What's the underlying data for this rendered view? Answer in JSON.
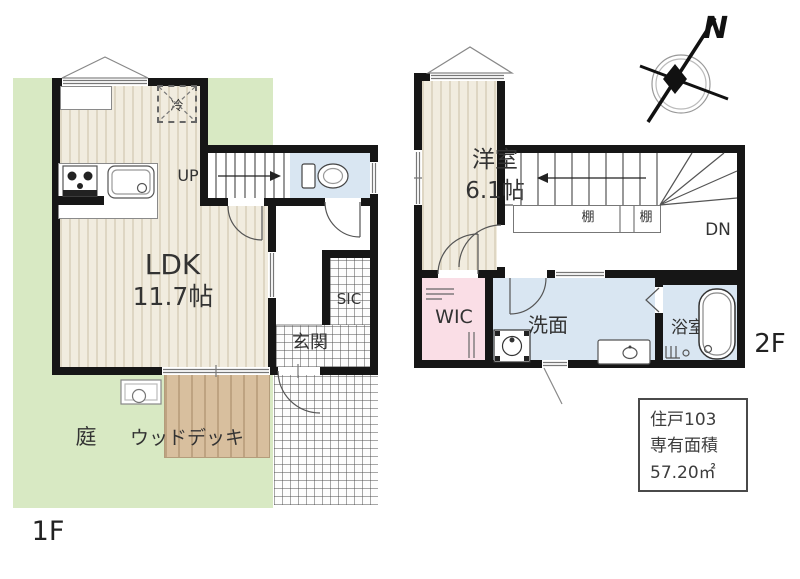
{
  "colors": {
    "garden_green": "#d8e9c3",
    "deck_tan": "#d8bf9e",
    "room_beige": "#f1ecdf",
    "water_blue": "#d9e6f2",
    "wic_pink": "#fadee6",
    "wall_black": "#161616"
  },
  "f1": {
    "floor_label": "1F",
    "ldk_name": "LDK",
    "ldk_size": "11.7帖",
    "garden": "庭",
    "wood_deck": "ウッドデッキ",
    "entrance": "玄関",
    "sic": "SIC",
    "up": "UP",
    "fridge": "冷"
  },
  "f2": {
    "floor_label": "2F",
    "room_name": "洋室",
    "room_size": "6.1帖",
    "wic": "WIC",
    "washroom": "洗面",
    "bathroom": "浴室",
    "shelf_left": "棚",
    "shelf_right": "棚",
    "dn": "DN"
  },
  "compass": {
    "north": "N"
  },
  "info_box": {
    "unit": "住戸103",
    "area_label": "専有面積",
    "area_value": "57.20㎡"
  }
}
